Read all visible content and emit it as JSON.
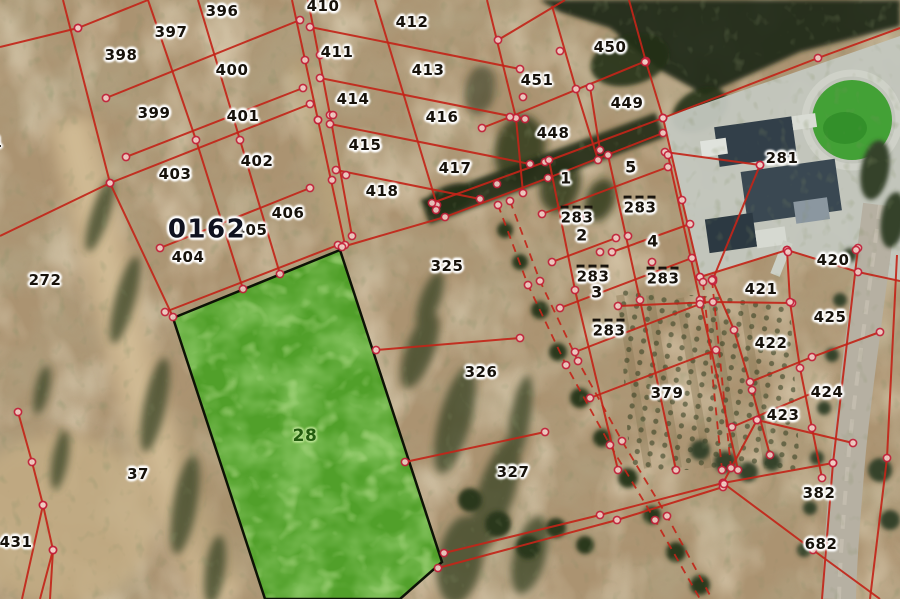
{
  "map": {
    "kind": "cadastral-aerial-map",
    "block_label": {
      "text": "0162"
    },
    "highlight_parcel": {
      "number": "28",
      "label_x": 305,
      "label_y": 437,
      "points": [
        [
          173,
          318
        ],
        [
          340,
          250
        ],
        [
          442,
          562
        ],
        [
          400,
          599
        ],
        [
          265,
          599
        ]
      ]
    },
    "parcel_labels": [
      {
        "t": "396",
        "x": 222,
        "y": 12
      },
      {
        "t": "397",
        "x": 171,
        "y": 33
      },
      {
        "t": "398",
        "x": 121,
        "y": 56
      },
      {
        "t": "400",
        "x": 232,
        "y": 71
      },
      {
        "t": "399",
        "x": 154,
        "y": 114
      },
      {
        "t": "401",
        "x": 243,
        "y": 117
      },
      {
        "t": "402",
        "x": 257,
        "y": 162
      },
      {
        "t": "403",
        "x": 175,
        "y": 175
      },
      {
        "t": "406",
        "x": 288,
        "y": 214
      },
      {
        "t": "405",
        "x": 251,
        "y": 231
      },
      {
        "t": "404",
        "x": 188,
        "y": 258
      },
      {
        "t": "272",
        "x": 45,
        "y": 281
      },
      {
        "t": "1",
        "x": -3,
        "y": 143
      },
      {
        "t": "0162",
        "x": 207,
        "y": 230,
        "k": "blk"
      },
      {
        "t": "410",
        "x": 323,
        "y": 7
      },
      {
        "t": "412",
        "x": 412,
        "y": 23
      },
      {
        "t": "411",
        "x": 337,
        "y": 53
      },
      {
        "t": "413",
        "x": 428,
        "y": 71
      },
      {
        "t": "414",
        "x": 353,
        "y": 100
      },
      {
        "t": "416",
        "x": 442,
        "y": 118
      },
      {
        "t": "415",
        "x": 365,
        "y": 146
      },
      {
        "t": "417",
        "x": 455,
        "y": 169
      },
      {
        "t": "418",
        "x": 382,
        "y": 192
      },
      {
        "t": "450",
        "x": 610,
        "y": 48
      },
      {
        "t": "451",
        "x": 537,
        "y": 81
      },
      {
        "t": "448",
        "x": 553,
        "y": 134
      },
      {
        "t": "449",
        "x": 627,
        "y": 104
      },
      {
        "t": "281",
        "x": 782,
        "y": 159
      },
      {
        "t": "1",
        "x": 566,
        "y": 179,
        "k": "sub"
      },
      {
        "t": "5",
        "x": 631,
        "y": 168,
        "k": "sub"
      },
      {
        "t": "2",
        "x": 582,
        "y": 236,
        "k": "sub"
      },
      {
        "t": "4",
        "x": 653,
        "y": 242,
        "k": "sub"
      },
      {
        "t": "3",
        "x": 597,
        "y": 293,
        "k": "sub"
      },
      {
        "t": "283",
        "x": 577,
        "y": 216,
        "k": "ov"
      },
      {
        "t": "283",
        "x": 640,
        "y": 206,
        "k": "ov"
      },
      {
        "t": "283",
        "x": 593,
        "y": 275,
        "k": "ov"
      },
      {
        "t": "283",
        "x": 663,
        "y": 277,
        "k": "ov"
      },
      {
        "t": "283",
        "x": 609,
        "y": 329,
        "k": "ov"
      },
      {
        "t": "325",
        "x": 447,
        "y": 267
      },
      {
        "t": "326",
        "x": 481,
        "y": 373
      },
      {
        "t": "379",
        "x": 667,
        "y": 394
      },
      {
        "t": "327",
        "x": 513,
        "y": 473
      },
      {
        "t": "420",
        "x": 833,
        "y": 261
      },
      {
        "t": "421",
        "x": 761,
        "y": 290
      },
      {
        "t": "425",
        "x": 830,
        "y": 318
      },
      {
        "t": "422",
        "x": 771,
        "y": 344
      },
      {
        "t": "424",
        "x": 827,
        "y": 393
      },
      {
        "t": "423",
        "x": 783,
        "y": 416
      },
      {
        "t": "382",
        "x": 819,
        "y": 494
      },
      {
        "t": "682",
        "x": 821,
        "y": 545
      },
      {
        "t": "37",
        "x": 138,
        "y": 475
      },
      {
        "t": "431",
        "x": 16,
        "y": 543
      }
    ],
    "boundaries": [
      {
        "pts": [
          [
            63,
            0
          ],
          [
            110,
            183
          ],
          [
            173,
            317
          ]
        ]
      },
      {
        "pts": [
          [
            148,
            0
          ],
          [
            196,
            140
          ],
          [
            243,
            289
          ]
        ]
      },
      {
        "pts": [
          [
            198,
            0
          ],
          [
            240,
            140
          ],
          [
            280,
            274
          ]
        ]
      },
      {
        "pts": [
          [
            292,
            0
          ],
          [
            318,
            120
          ],
          [
            345,
            245
          ]
        ]
      },
      {
        "pts": [
          [
            308,
            0
          ],
          [
            330,
            115
          ],
          [
            352,
            236
          ]
        ]
      },
      {
        "pts": [
          [
            78,
            28
          ],
          [
            148,
            0
          ]
        ]
      },
      {
        "pts": [
          [
            78,
            28
          ],
          [
            0,
            47
          ]
        ]
      },
      {
        "pts": [
          [
            106,
            98
          ],
          [
            300,
            20
          ]
        ]
      },
      {
        "pts": [
          [
            126,
            157
          ],
          [
            303,
            88
          ]
        ]
      },
      {
        "pts": [
          [
            0,
            236
          ],
          [
            110,
            183
          ],
          [
            310,
            104
          ]
        ]
      },
      {
        "pts": [
          [
            160,
            248
          ],
          [
            310,
            188
          ]
        ]
      },
      {
        "pts": [
          [
            165,
            312
          ],
          [
            338,
            245
          ]
        ]
      },
      {
        "pts": [
          [
            375,
            0
          ],
          [
            437,
            205
          ]
        ]
      },
      {
        "pts": [
          [
            487,
            0
          ],
          [
            516,
            118
          ],
          [
            523,
            193
          ]
        ]
      },
      {
        "pts": [
          [
            310,
            27
          ],
          [
            520,
            69
          ]
        ]
      },
      {
        "pts": [
          [
            320,
            78
          ],
          [
            525,
            119
          ]
        ]
      },
      {
        "pts": [
          [
            330,
            124
          ],
          [
            530,
            164
          ]
        ]
      },
      {
        "pts": [
          [
            336,
            170
          ],
          [
            480,
            199
          ]
        ]
      },
      {
        "pts": [
          [
            629,
            0
          ],
          [
            646,
            62
          ],
          [
            663,
            118
          ]
        ]
      },
      {
        "pts": [
          [
            646,
            61
          ],
          [
            510,
            117
          ],
          [
            482,
            128
          ]
        ]
      },
      {
        "pts": [
          [
            552,
            6
          ],
          [
            576,
            89
          ],
          [
            598,
            160
          ]
        ]
      },
      {
        "pts": [
          [
            590,
            87
          ],
          [
            600,
            150
          ]
        ]
      },
      {
        "pts": [
          [
            498,
            40
          ],
          [
            565,
            0
          ]
        ]
      },
      {
        "pts": [
          [
            432,
            203
          ],
          [
            545,
            162
          ],
          [
            663,
            118
          ],
          [
            818,
            58
          ],
          [
            900,
            28
          ]
        ]
      },
      {
        "pts": [
          [
            342,
            247
          ],
          [
            445,
            217
          ],
          [
            548,
            178
          ],
          [
            663,
            133
          ]
        ]
      },
      {
        "pts": [
          [
            663,
            118
          ],
          [
            682,
            200
          ],
          [
            700,
            277
          ]
        ]
      },
      {
        "pts": [
          [
            700,
            277
          ],
          [
            787,
            250
          ],
          [
            858,
            272
          ],
          [
            900,
            281
          ]
        ]
      },
      {
        "pts": [
          [
            665,
            152
          ],
          [
            760,
            165
          ]
        ]
      },
      {
        "pts": [
          [
            760,
            165
          ],
          [
            713,
            279
          ]
        ]
      },
      {
        "pts": [
          [
            549,
            160
          ],
          [
            575,
            290
          ],
          [
            618,
            470
          ]
        ]
      },
      {
        "pts": [
          [
            608,
            155
          ],
          [
            640,
            300
          ],
          [
            676,
            470
          ]
        ]
      },
      {
        "pts": [
          [
            668,
            155
          ],
          [
            700,
            300
          ],
          [
            738,
            470
          ]
        ]
      },
      {
        "pts": [
          [
            542,
            214
          ],
          [
            668,
            167
          ]
        ]
      },
      {
        "pts": [
          [
            552,
            262
          ],
          [
            616,
            238
          ]
        ]
      },
      {
        "pts": [
          [
            612,
            252
          ],
          [
            690,
            224
          ]
        ]
      },
      {
        "pts": [
          [
            560,
            308
          ],
          [
            692,
            258
          ]
        ]
      },
      {
        "pts": [
          [
            575,
            352
          ],
          [
            700,
            304
          ]
        ]
      },
      {
        "pts": [
          [
            590,
            398
          ],
          [
            716,
            350
          ]
        ]
      },
      {
        "pts": [
          [
            618,
            306
          ],
          [
            713,
            302
          ],
          [
            792,
            303
          ]
        ]
      },
      {
        "pts": [
          [
            787,
            250
          ],
          [
            790,
            302
          ],
          [
            800,
            368
          ],
          [
            812,
            428
          ],
          [
            822,
            478
          ]
        ]
      },
      {
        "pts": [
          [
            713,
            281
          ],
          [
            734,
            330
          ],
          [
            752,
            390
          ],
          [
            770,
            455
          ]
        ]
      },
      {
        "pts": [
          [
            732,
            427
          ],
          [
            815,
            392
          ]
        ]
      },
      {
        "pts": [
          [
            750,
            382
          ],
          [
            812,
            357
          ],
          [
            880,
            332
          ]
        ]
      },
      {
        "pts": [
          [
            757,
            420
          ],
          [
            853,
            443
          ]
        ]
      },
      {
        "pts": [
          [
            757,
            420
          ],
          [
            723,
            483
          ]
        ]
      },
      {
        "pts": [
          [
            858,
            248
          ],
          [
            833,
            463
          ],
          [
            822,
            599
          ]
        ]
      },
      {
        "pts": [
          [
            897,
            255
          ],
          [
            887,
            458
          ],
          [
            870,
            599
          ]
        ]
      },
      {
        "pts": [
          [
            723,
            483
          ],
          [
            833,
            463
          ]
        ]
      },
      {
        "pts": [
          [
            723,
            483
          ],
          [
            813,
            550
          ],
          [
            880,
            599
          ]
        ]
      },
      {
        "pts": [
          [
            444,
            553
          ],
          [
            600,
            515
          ],
          [
            723,
            483
          ]
        ]
      },
      {
        "pts": [
          [
            438,
            568
          ],
          [
            617,
            520
          ],
          [
            723,
            487
          ]
        ]
      },
      {
        "pts": [
          [
            405,
            462
          ],
          [
            545,
            432
          ]
        ]
      },
      {
        "pts": [
          [
            376,
            350
          ],
          [
            520,
            338
          ]
        ]
      },
      {
        "pts": [
          [
            18,
            412
          ],
          [
            32,
            462
          ],
          [
            43,
            505
          ],
          [
            53,
            550
          ],
          [
            50,
            599
          ]
        ]
      },
      {
        "pts": [
          [
            43,
            505
          ],
          [
            22,
            599
          ]
        ]
      },
      {
        "pts": [
          [
            53,
            550
          ],
          [
            40,
            599
          ]
        ]
      },
      {
        "pts": [
          [
            498,
            205
          ],
          [
            528,
            285
          ],
          [
            566,
            365
          ],
          [
            610,
            445
          ],
          [
            655,
            520
          ],
          [
            700,
            599
          ]
        ],
        "dash": 1
      },
      {
        "pts": [
          [
            510,
            201
          ],
          [
            540,
            281
          ],
          [
            578,
            361
          ],
          [
            622,
            441
          ],
          [
            667,
            516
          ],
          [
            712,
            599
          ]
        ],
        "dash": 1
      },
      {
        "pts": [
          [
            703,
            282
          ],
          [
            722,
            470
          ]
        ],
        "dash": 1
      },
      {
        "pts": [
          [
            712,
            280
          ],
          [
            731,
            468
          ]
        ],
        "dash": 1
      }
    ],
    "extra_dots": [
      [
        305,
        60
      ],
      [
        318,
        120
      ],
      [
        332,
        180
      ],
      [
        320,
        55
      ],
      [
        333,
        115
      ],
      [
        346,
        175
      ],
      [
        523,
        97
      ],
      [
        497,
        184
      ],
      [
        436,
        210
      ],
      [
        580,
        218
      ],
      [
        628,
        236
      ],
      [
        600,
        252
      ],
      [
        652,
        262
      ],
      [
        610,
        330
      ],
      [
        856,
        250
      ],
      [
        724,
        484
      ],
      [
        788,
        252
      ],
      [
        645,
        62
      ],
      [
        560,
        51
      ]
    ],
    "colors": {
      "boundary_red": "#c22519",
      "vertex_ring": "#c3203a",
      "vertex_fill": "#f0cdc5",
      "label_ink": "#17120b",
      "block_label_ink": "#10121f",
      "highlight_fill": "#51a02a",
      "highlight_border": "#0d1206",
      "highlight_label_ink": "#235c0f"
    }
  }
}
